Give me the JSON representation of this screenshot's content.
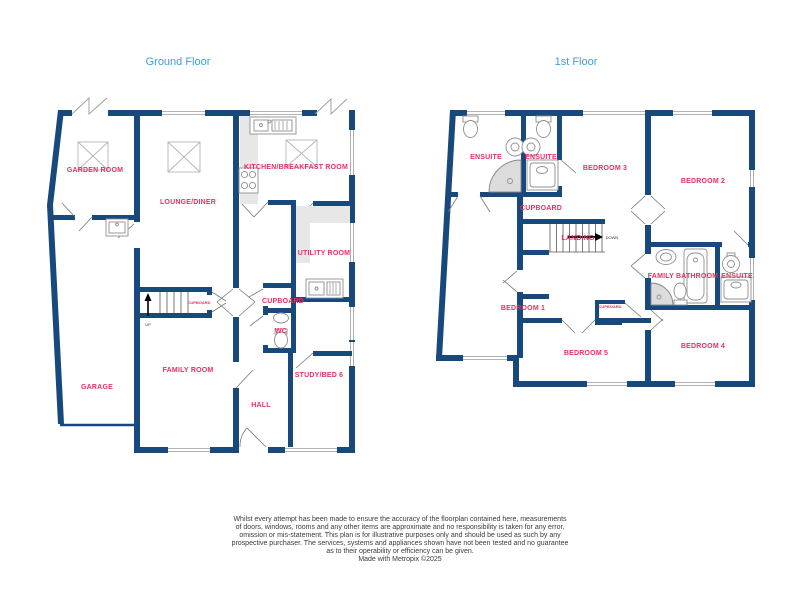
{
  "ground": {
    "title": "Ground Floor",
    "garden_room": "GARDEN ROOM",
    "lounge_diner": "LOUNGE/DINER",
    "kitchen": "KITCHEN/BREAKFAST ROOM",
    "utility": "UTILITY ROOM",
    "cupboard": "CUPBOARD",
    "cupboard_stairs": "CUPBOARD",
    "wc": "WC",
    "family_room": "FAMILY ROOM",
    "garage": "GARAGE",
    "hall": "HALL",
    "study": "STUDY/BED 6",
    "up": "UP"
  },
  "first": {
    "title": "1st Floor",
    "ensuite_1": "ENSUITE",
    "ensuite_2": "ENSUITE",
    "bedroom_3": "BEDROOM 3",
    "bedroom_2": "BEDROOM 2",
    "cupboard": "CUPBOARD",
    "landing": "LANDING",
    "down": "DOWN",
    "family_bathroom": "FAMILY BATHROOM",
    "ensuite_4": "ENSUITE",
    "bedroom_1": "BEDROOM 1",
    "cupboard_small": "CUPBOARD",
    "bedroom_5": "BEDROOM 5",
    "bedroom_4": "BEDROOM 4"
  },
  "colors": {
    "wall_navy": "#17497C",
    "room_label_pink": "#ED2E63",
    "floor_title_blue": "#33A3DC"
  },
  "footer": {
    "disclaimer_lines": [
      "Whilst every attempt has been made to ensure the accuracy of the floorplan contained here, measurements",
      "of doors, windows, rooms and any other items are approximate and no responsibility is taken for any error,",
      "omission or mis-statement. This plan is for illustrative purposes only and should be used as such by any",
      "prospective purchaser. The services, systems and appliances shown have not been tested and no guarantee",
      "as to their operability or efficiency can be given."
    ],
    "made_with": "Made with Metropix ©2025"
  }
}
